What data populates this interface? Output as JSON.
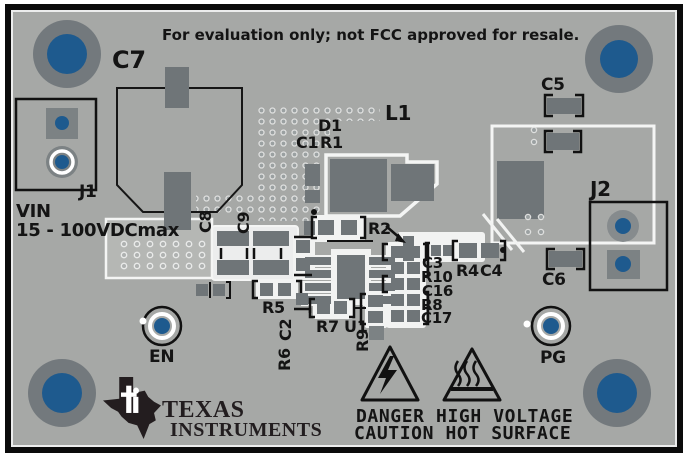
{
  "banner": "For evaluation only; not FCC approved for resale.",
  "input": {
    "vin": "VIN",
    "range": "15 - 100VDCmax"
  },
  "refdes": {
    "c7": "C7",
    "c5": "C5",
    "c6": "C6",
    "c8": "C8",
    "c9": "C9",
    "l1": "L1",
    "d1": "D1",
    "c1": "C1",
    "r1": "R1",
    "r2": "R2",
    "c3": "C3",
    "r4": "R4",
    "c4": "C4",
    "r10": "R10",
    "c16": "C16",
    "r8": "R8",
    "c17": "C17",
    "r5": "R5",
    "c2": "C2",
    "r6": "R6",
    "r7": "R7",
    "u1": "U1",
    "r9": "R9",
    "j1": "J1",
    "j2": "J2"
  },
  "testpoints": {
    "en": "EN",
    "pg": "PG"
  },
  "warnings": {
    "line1": "DANGER HIGH VOLTAGE",
    "line2": "CAUTION HOT SURFACE"
  },
  "logo": {
    "line1": "TEXAS",
    "line2": "INSTRUMENTS"
  },
  "icons": {
    "high_voltage_warning": "triangle-lightning",
    "hot_surface_warning": "triangle-heat",
    "brand": "texas-instruments-logo"
  },
  "colors": {
    "board": "#a6a8a6",
    "copper_pour": "#b5b7b4",
    "pad_dark": "#6f7578",
    "pad_mid": "#7c8284",
    "drill_blue": "#1e5a8e",
    "hole_ring": "#73797d",
    "silkscreen_black": "#141414",
    "mask_white": "#f2f3f2",
    "frame": "#0b0b0b"
  }
}
